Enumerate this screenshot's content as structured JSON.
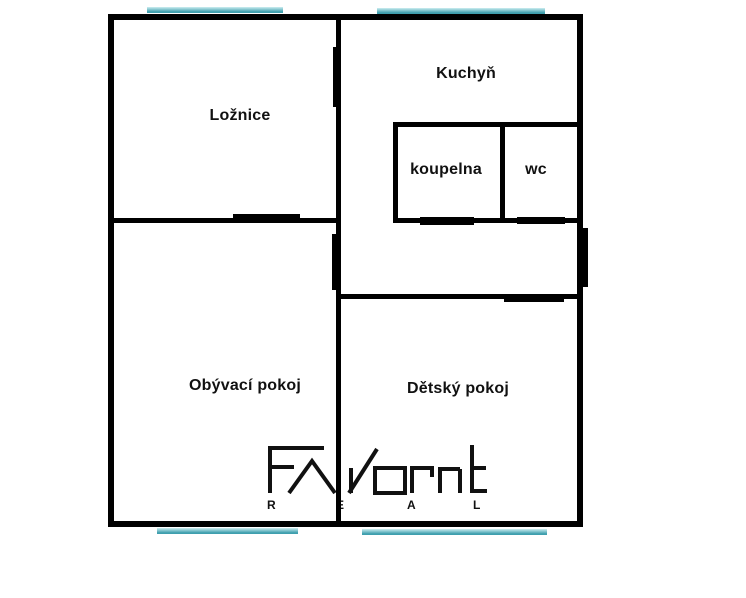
{
  "floorplan": {
    "rooms": {
      "loznice": {
        "label": "Ložnice"
      },
      "kuchyn": {
        "label": "Kuchyň"
      },
      "koupelna": {
        "label": "koupelna"
      },
      "wc": {
        "label": "wc"
      },
      "obyvaci_pokoj": {
        "label": "Obývací pokoj"
      },
      "detsky_pokoj": {
        "label": "Dětský pokoj"
      }
    },
    "logo": {
      "brand": "FAVORIT",
      "subtitle_letters": [
        "R",
        "E",
        "A",
        "L"
      ]
    },
    "colors": {
      "wall": "#000000",
      "window_top": "#cdeef1",
      "window_bottom": "#3f9fae",
      "background": "#ffffff",
      "logo_ink": "#111111"
    }
  }
}
